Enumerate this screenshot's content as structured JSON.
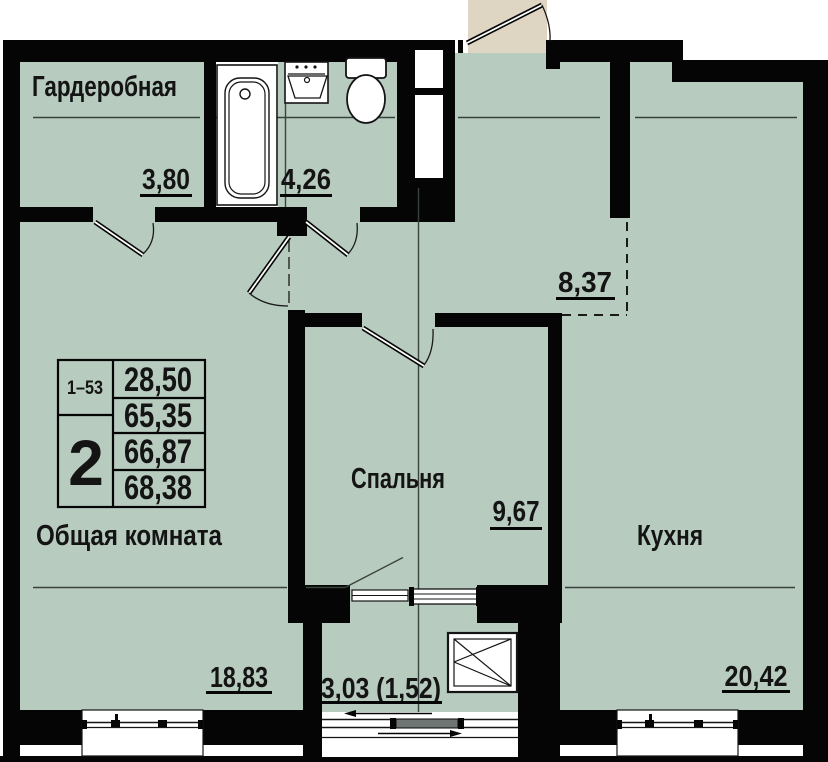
{
  "title": "Apartment floor plan",
  "rooms": {
    "wardrobe": {
      "label": "Гардеробная",
      "area": "3,80"
    },
    "bathroom": {
      "area": "4,26"
    },
    "hallway": {
      "area": "8,37"
    },
    "bedroom": {
      "label": "Спальня",
      "area": "9,67"
    },
    "kitchen": {
      "label": "Кухня",
      "area": "20,42"
    },
    "living_room": {
      "label": "Общая комната",
      "area": "18,83"
    },
    "balcony": {
      "area": "3,03 (1,52)"
    }
  },
  "stamp": {
    "apartment_numbers": "1–53",
    "room_count": "2",
    "areas": [
      "28,50",
      "65,35",
      "66,87",
      "68,38"
    ]
  },
  "colors": {
    "floor": "#b7cbbf",
    "exterior": "#ded6c3",
    "wall": "#050505",
    "section_line": "#39433d"
  }
}
